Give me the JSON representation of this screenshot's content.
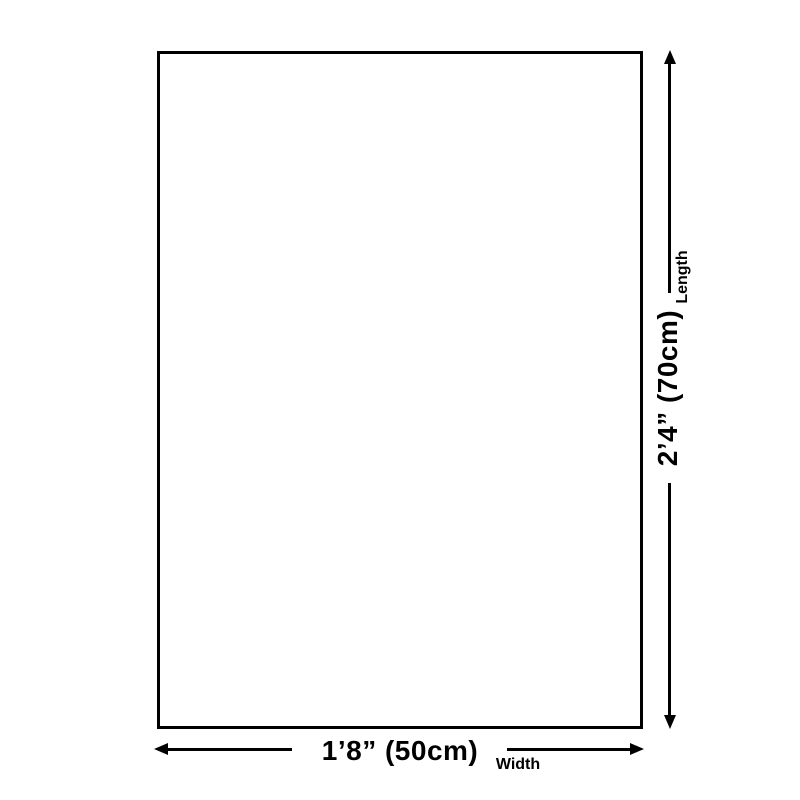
{
  "page": {
    "background_color": "#ffffff",
    "ink_color": "#000000"
  },
  "diagram": {
    "shape": "rectangle-outline",
    "length": {
      "value": "2’4” (70cm)",
      "label": "Length"
    },
    "width": {
      "value": "1’8” (50cm)",
      "label": "Width"
    }
  }
}
